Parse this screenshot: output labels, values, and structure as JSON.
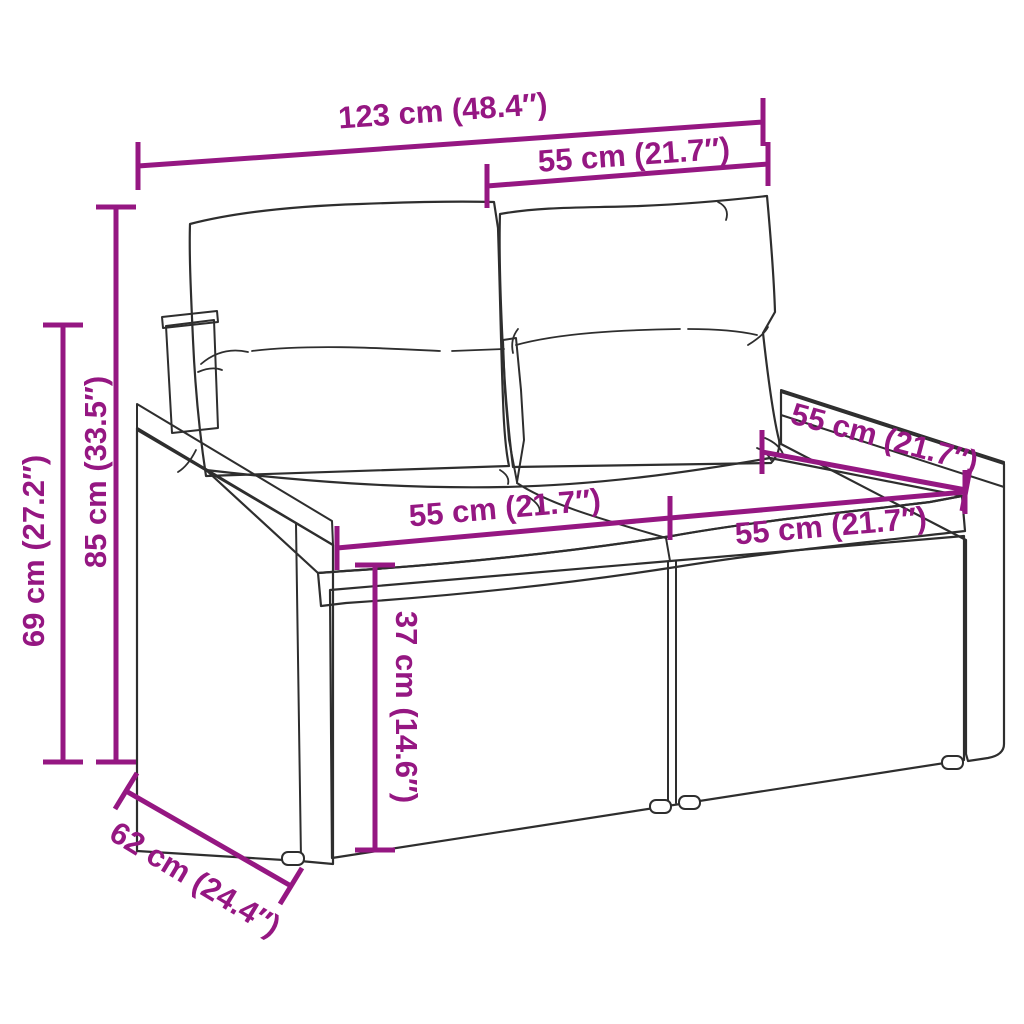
{
  "page": {
    "background": "#ffffff"
  },
  "diagram": {
    "subject": "rattan two-seater garden sofa with cushions — dimension line drawing",
    "accent_color": "#951782",
    "ink_color": "#2e2e2e",
    "dimensions": {
      "overall_width": "123 cm (48.4″)",
      "upper_section_width": "55 cm (21.7″)",
      "total_height": "85 cm (33.5″)",
      "armrest_height": "69 cm (27.2″)",
      "seat_width_left": "55 cm (21.7″)",
      "seat_width_right": "55 cm (21.7″)",
      "seat_depth": "55 cm (21.7″)",
      "seat_height": "37 cm (14.6″)",
      "overall_depth": "62 cm (24.4″)"
    }
  }
}
